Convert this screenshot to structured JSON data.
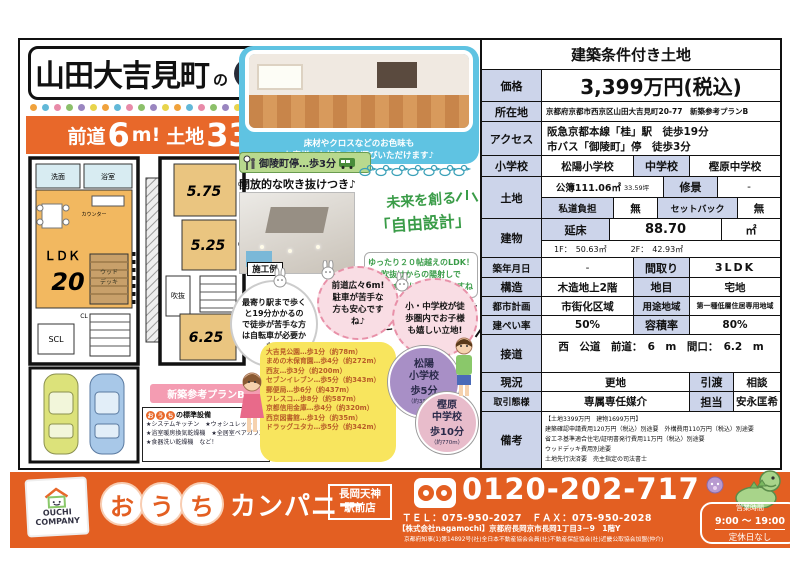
{
  "flyer": {
    "title": {
      "main": "山田大吉見町",
      "particle": "の",
      "brand_circles": [
        "お",
        "う",
        "ち"
      ]
    },
    "banner": {
      "pre": "前道",
      "num1": "6",
      "unit1": "m!",
      "mid": "土地",
      "num2": "33",
      "post": "坪越え!"
    },
    "photo_caption": [
      "床材やクロスなどのお色味も",
      "お客様のお好みでお選びいただけます♪"
    ],
    "bus_stop": "御陵町停…歩3分",
    "void_note": "開放的な吹き抜けつき♪",
    "photo_label": "施工例",
    "free_design": {
      "line1": "未来を創る",
      "line2": "「自由設計」"
    },
    "ldk_note": [
      "ゆったり２０帖越えのLDK！",
      "吹抜けからの陽射しで",
      "明るい食卓になりそうですね♪"
    ],
    "merit": [
      "メリット・デメリットを",
      "ピックアップ!"
    ],
    "bubbles": [
      {
        "text": "最寄り駅まで歩くと19分かかるので徒歩が苦手な方は自転車が必要かも…"
      },
      {
        "text": "前道広々6m! 駐車が苦手な方も安心ですね♪"
      },
      {
        "text": "小・中学校が徒歩圏内でお子様も嬉しい立地!"
      }
    ],
    "distance_list": [
      "大吉見公園…歩1分（約78m）",
      "まめの木保育園…歩4分（約272m）",
      "西友…歩3分（約200m）",
      "セブンイレブン…歩5分（約343m）",
      "郵便局…歩6分（約437m）",
      "フレスコ…歩8分（約587m）",
      "京都信用金庫…歩4分（約320m）",
      "西京図書館…歩1分（約35m）",
      "ドラッグユタカ…歩5分（約342m）"
    ],
    "school_circles": [
      {
        "name1": "松陽",
        "name2": "小学校",
        "time": "歩5分",
        "dist": "（約337m）"
      },
      {
        "name1": "樫原",
        "name2": "中学校",
        "time": "歩10分",
        "dist": "（約770m）"
      }
    ],
    "plan_label": "新築参考プランB",
    "equipment": {
      "brand": [
        "お",
        "う",
        "ち"
      ],
      "title_rest": "の標準設備",
      "items": [
        "★システムキッチン　★ウォシュレット",
        "★浴室暖房換気乾燥機　★全居室ペアガラス",
        "★食器洗い乾燥機　など！"
      ]
    },
    "floorplan": {
      "ldk": "ＬＤＫ",
      "ldk_size": "20",
      "washroom": "洗面",
      "bath": "浴室",
      "counter": "カウンター",
      "wood_deck_1": "ウッド",
      "wood_deck_2": "デッキ",
      "scl": "SCL",
      "cl": "CL",
      "void": "吹抜",
      "room1": "5.75",
      "room2": "5.25",
      "room3": "6.25"
    }
  },
  "table": {
    "header": "建築条件付き土地",
    "price_label": "価格",
    "price": "3,399万円(税込)",
    "location_label": "所在地",
    "location": "京都府京都市西京区山田大吉見町20-77　新築参考プランB",
    "access_label": "アクセス",
    "access1": "阪急京都本線「桂」駅　徒歩19分",
    "access2": "市バス「御陵町」停　徒歩3分",
    "elementary_label": "小学校",
    "elementary": "松陽小学校",
    "junior_label": "中学校",
    "junior": "樫原中学校",
    "land_label": "土地",
    "land_area": "公簿111.06㎡",
    "land_tsubo": "33.59坪",
    "shukei_label": "修景",
    "shukei": "-",
    "private_road_label": "私道負担",
    "private_road": "無",
    "setback_label": "セットバック",
    "setback": "無",
    "building_label": "建物",
    "floor_area_label": "延床",
    "floor_area": "88.70",
    "floor_area_unit": "㎡",
    "floors_detail": "1F：　50.63㎡　　　2F：　42.93㎡",
    "built_label": "築年月日",
    "built": "-",
    "madori_label": "間取り",
    "madori": "3LDK",
    "structure_label": "構造",
    "structure": "木造地上2階",
    "chimoku_label": "地目",
    "chimoku": "宅地",
    "city_plan_label": "都市計画",
    "city_plan": "市街化区域",
    "yoto_label": "用途地域",
    "yoto": "第一種低層住居専用地域",
    "kenpei_label": "建ぺい率",
    "kenpei": "50%",
    "yoseki_label": "容積率",
    "yoseki": "80%",
    "road_label": "接道",
    "road": "西　公道　前道：　6　m　間口：　6.2　m",
    "genkyo_label": "現況",
    "genkyo": "更地",
    "hikiwatashi_label": "引渡",
    "hikiwatashi": "相談",
    "torihiki_label": "取引態様",
    "torihiki": "専属専任媒介",
    "tanto_label": "担当",
    "tanto": "安永匡希",
    "biko_label": "備考",
    "biko_lines": [
      "【土地3399万円　建物1699万円】",
      "建築確認申請費用120万円（税込）別途要　外構費用110万円（税込）別途要",
      "省エネ基準適合住宅/証明書発行費用11万円（税込）別途要",
      "ウッドデッキ費用別途要",
      "土地先行決済要　売主指定の司法書士"
    ]
  },
  "footer": {
    "logo_line1": "OUCHI",
    "logo_line2": "COMPANY",
    "brand_circles": [
      "お",
      "う",
      "ち"
    ],
    "brand_rest": "カンパニー",
    "branch": [
      "長岡天神",
      "駅前店"
    ],
    "phone": "0120-202-717",
    "tel_fax": "ＴＥＬ：075-950-2027　ＦＡＸ：075-950-2028",
    "company": "【株式会社nagamochi】京都府長岡京市長岡1丁目3－9　1階Y",
    "license": "京都府知事(1)第14892号(社)全日本不動産協会会員(社)不動産保証協会(社)近畿公取協会加盟(仲介)",
    "hours": [
      "営業時間",
      "9:00 ～ 19:00",
      "定休日なし"
    ]
  },
  "colors": {
    "accent_orange": "#e8682a",
    "footer_orange": "#e35f22",
    "table_label_bg": "#ccd4ea",
    "yellow_box": "#f8e55e",
    "blue_frame": "#5fc3e2",
    "ldk_fill": "#f2b860"
  }
}
